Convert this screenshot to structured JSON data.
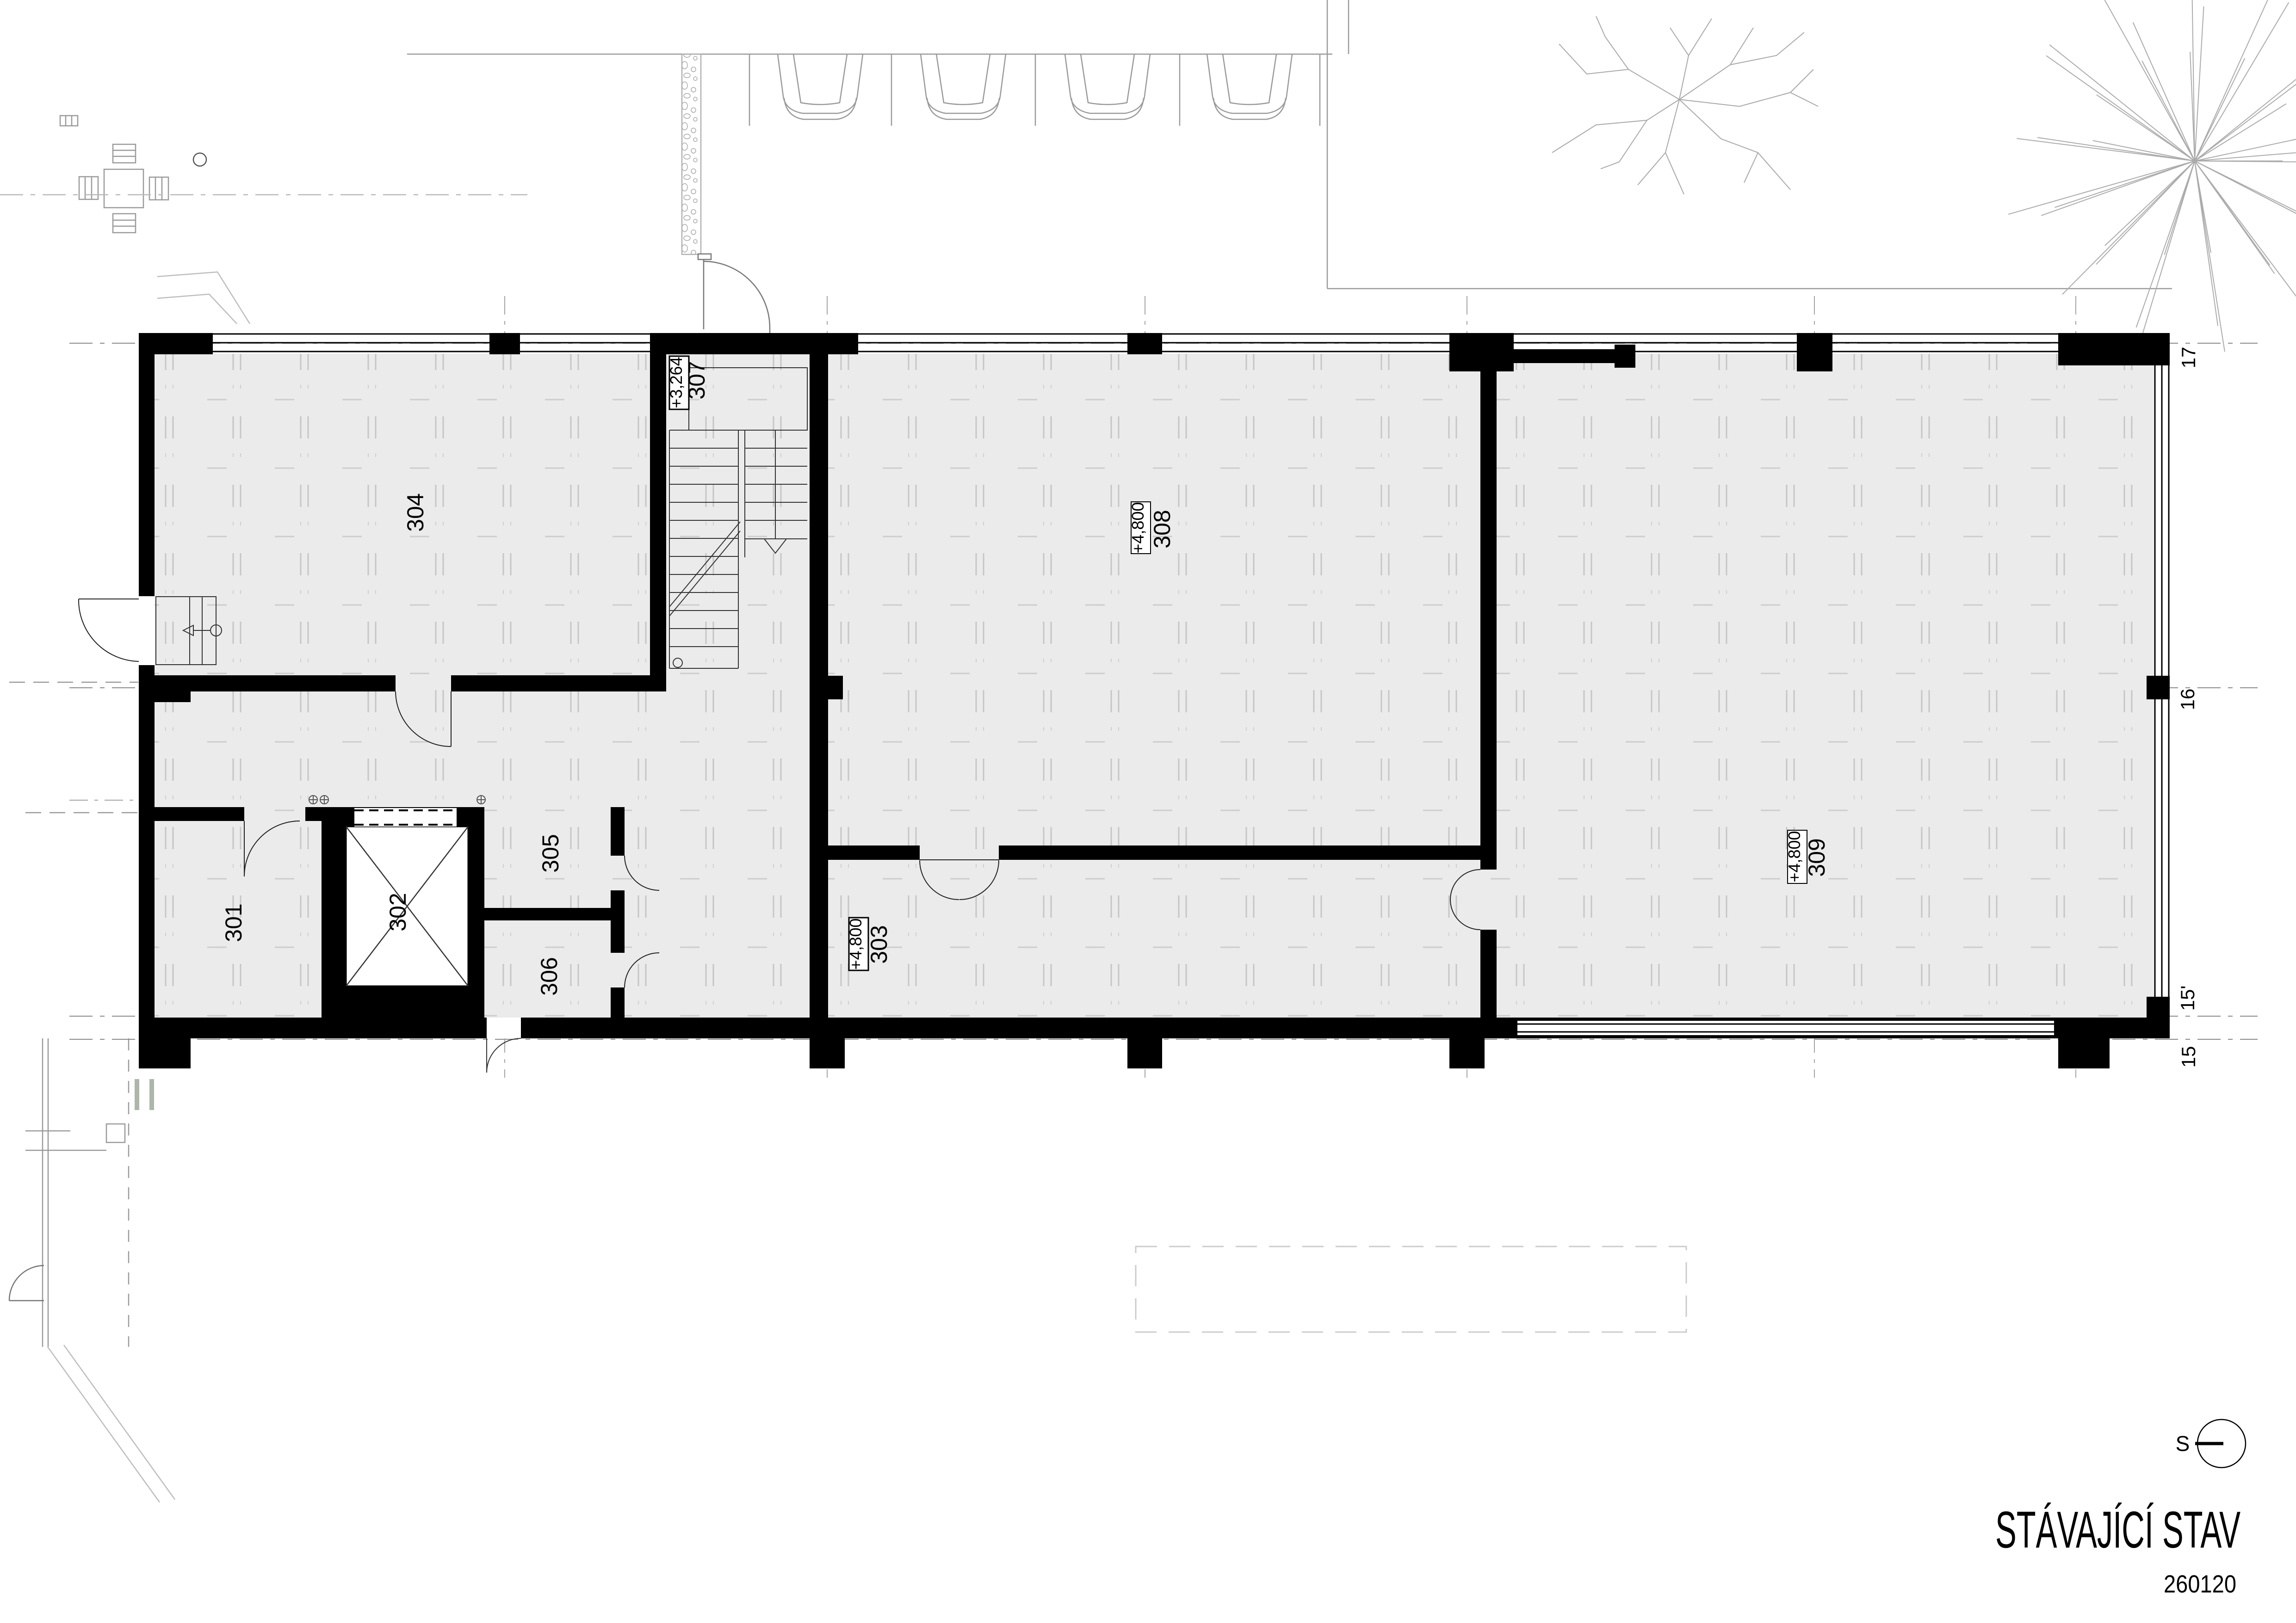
{
  "title": {
    "main": "STÁVAJÍCÍ STAV",
    "number": "260120"
  },
  "north": {
    "label": "S"
  },
  "rooms": {
    "r301": {
      "number": "301"
    },
    "r302": {
      "number": "302"
    },
    "r303": {
      "number": "303",
      "level": "+4,800"
    },
    "r304": {
      "number": "304"
    },
    "r305": {
      "number": "305"
    },
    "r306": {
      "number": "306"
    },
    "r307": {
      "number": "307",
      "level": "+3,264"
    },
    "r308": {
      "number": "308",
      "level": "+4,800"
    },
    "r309": {
      "number": "309",
      "level": "+4,800"
    }
  },
  "grid": {
    "axes": [
      {
        "label": "17"
      },
      {
        "label": "16"
      },
      {
        "label": "15'"
      },
      {
        "label": "15"
      }
    ]
  },
  "colors": {
    "wall": "#000000",
    "floor": "#ebebeb",
    "floor_joint": "#c6c6c6",
    "grid_line": "#6e6e6e",
    "site_line": "#9a9a9a",
    "detail_line": "#333333"
  }
}
